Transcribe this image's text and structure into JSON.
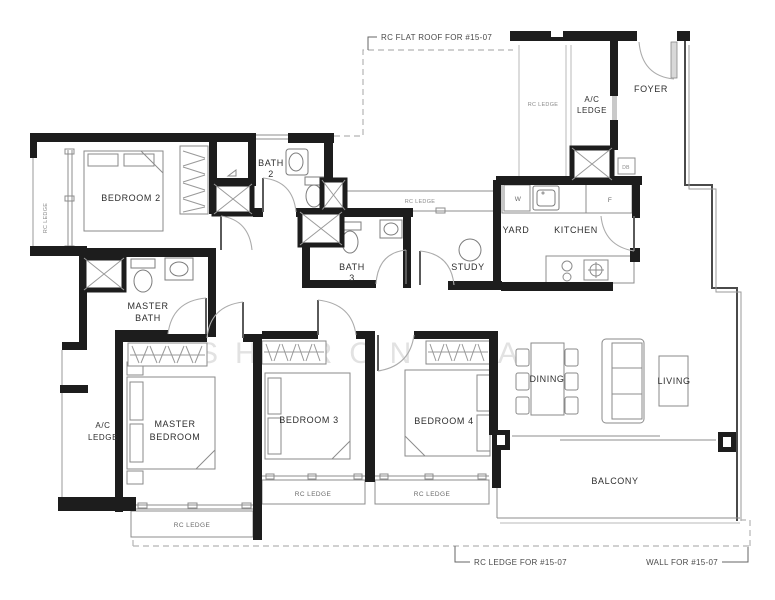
{
  "rooms": {
    "bedroom2": "BEDROOM 2",
    "bath2_1": "BATH",
    "bath2_2": "2",
    "bath3_1": "BATH",
    "bath3_2": "3",
    "master_bath_1": "MASTER",
    "master_bath_2": "BATH",
    "master_bedroom_1": "MASTER",
    "master_bedroom_2": "BEDROOM",
    "bedroom3": "BEDROOM 3",
    "bedroom4": "BEDROOM 4",
    "study": "STUDY",
    "yard": "YARD",
    "kitchen": "KITCHEN",
    "foyer": "FOYER",
    "dining": "DINING",
    "living": "LIVING",
    "balcony": "BALCONY",
    "ac_top_1": "A/C",
    "ac_top_2": "LEDGE",
    "ac_left_1": "A/C",
    "ac_left_2": "LEDGE"
  },
  "ledges": {
    "vertical": "RC LEDGE",
    "top": "RC LEDGE",
    "mid": "RC LEDGE",
    "master": "RC LEDGE",
    "bed3": "RC LEDGE",
    "bed4": "RC LEDGE"
  },
  "appliances": {
    "washer": "W",
    "fridge": "F",
    "db": "DB"
  },
  "annotations": {
    "flat_roof": "RC FLAT ROOF FOR #15-07",
    "rc_ledge_for": "RC LEDGE FOR #15-07",
    "wall_for": "WALL FOR #15-07"
  },
  "watermark": "SHARON WAN",
  "colors": {
    "wall": "#1d1d1d",
    "line": "#8c8c8c",
    "dashed_boundary": "#b5b5b5",
    "label_text": "#2e2e2e",
    "watermark": "#e2e2e2"
  }
}
